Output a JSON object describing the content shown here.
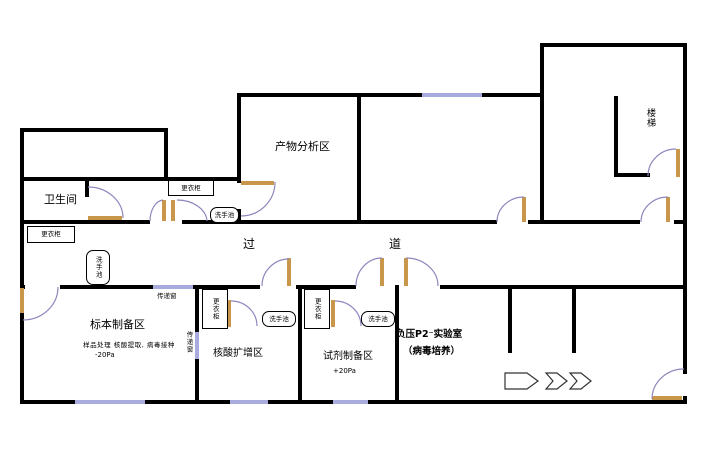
{
  "rooms": {
    "toilet": {
      "label": "卫生间"
    },
    "product_analysis": {
      "label": "产物分析区"
    },
    "stairs": {
      "label": "楼梯"
    },
    "corridor": {
      "left_char": "过",
      "right_char": "道"
    },
    "specimen_prep": {
      "label": "标本制备区",
      "sublabel": "样品处理 核酸提取, 病毒接种",
      "pressure": "-20Pa"
    },
    "amplification": {
      "label": "核酸扩增区"
    },
    "reagent_prep": {
      "label": "试剂制备区",
      "pressure": "+20Pa"
    },
    "p2_lab": {
      "label": "负压P2⁻实验室",
      "sublabel": "（病毒培养）"
    }
  },
  "fixtures": {
    "wardrobe": "更衣柜",
    "sink": "洗手池",
    "pass_window": "传递窗"
  },
  "icons": {
    "flow_arrows": "three right-pointing workflow arrows"
  },
  "colors": {
    "wall": "#000000",
    "window": "#a9aade",
    "door_leaf": "#c9974b",
    "door_arc": "#8e87bd"
  }
}
